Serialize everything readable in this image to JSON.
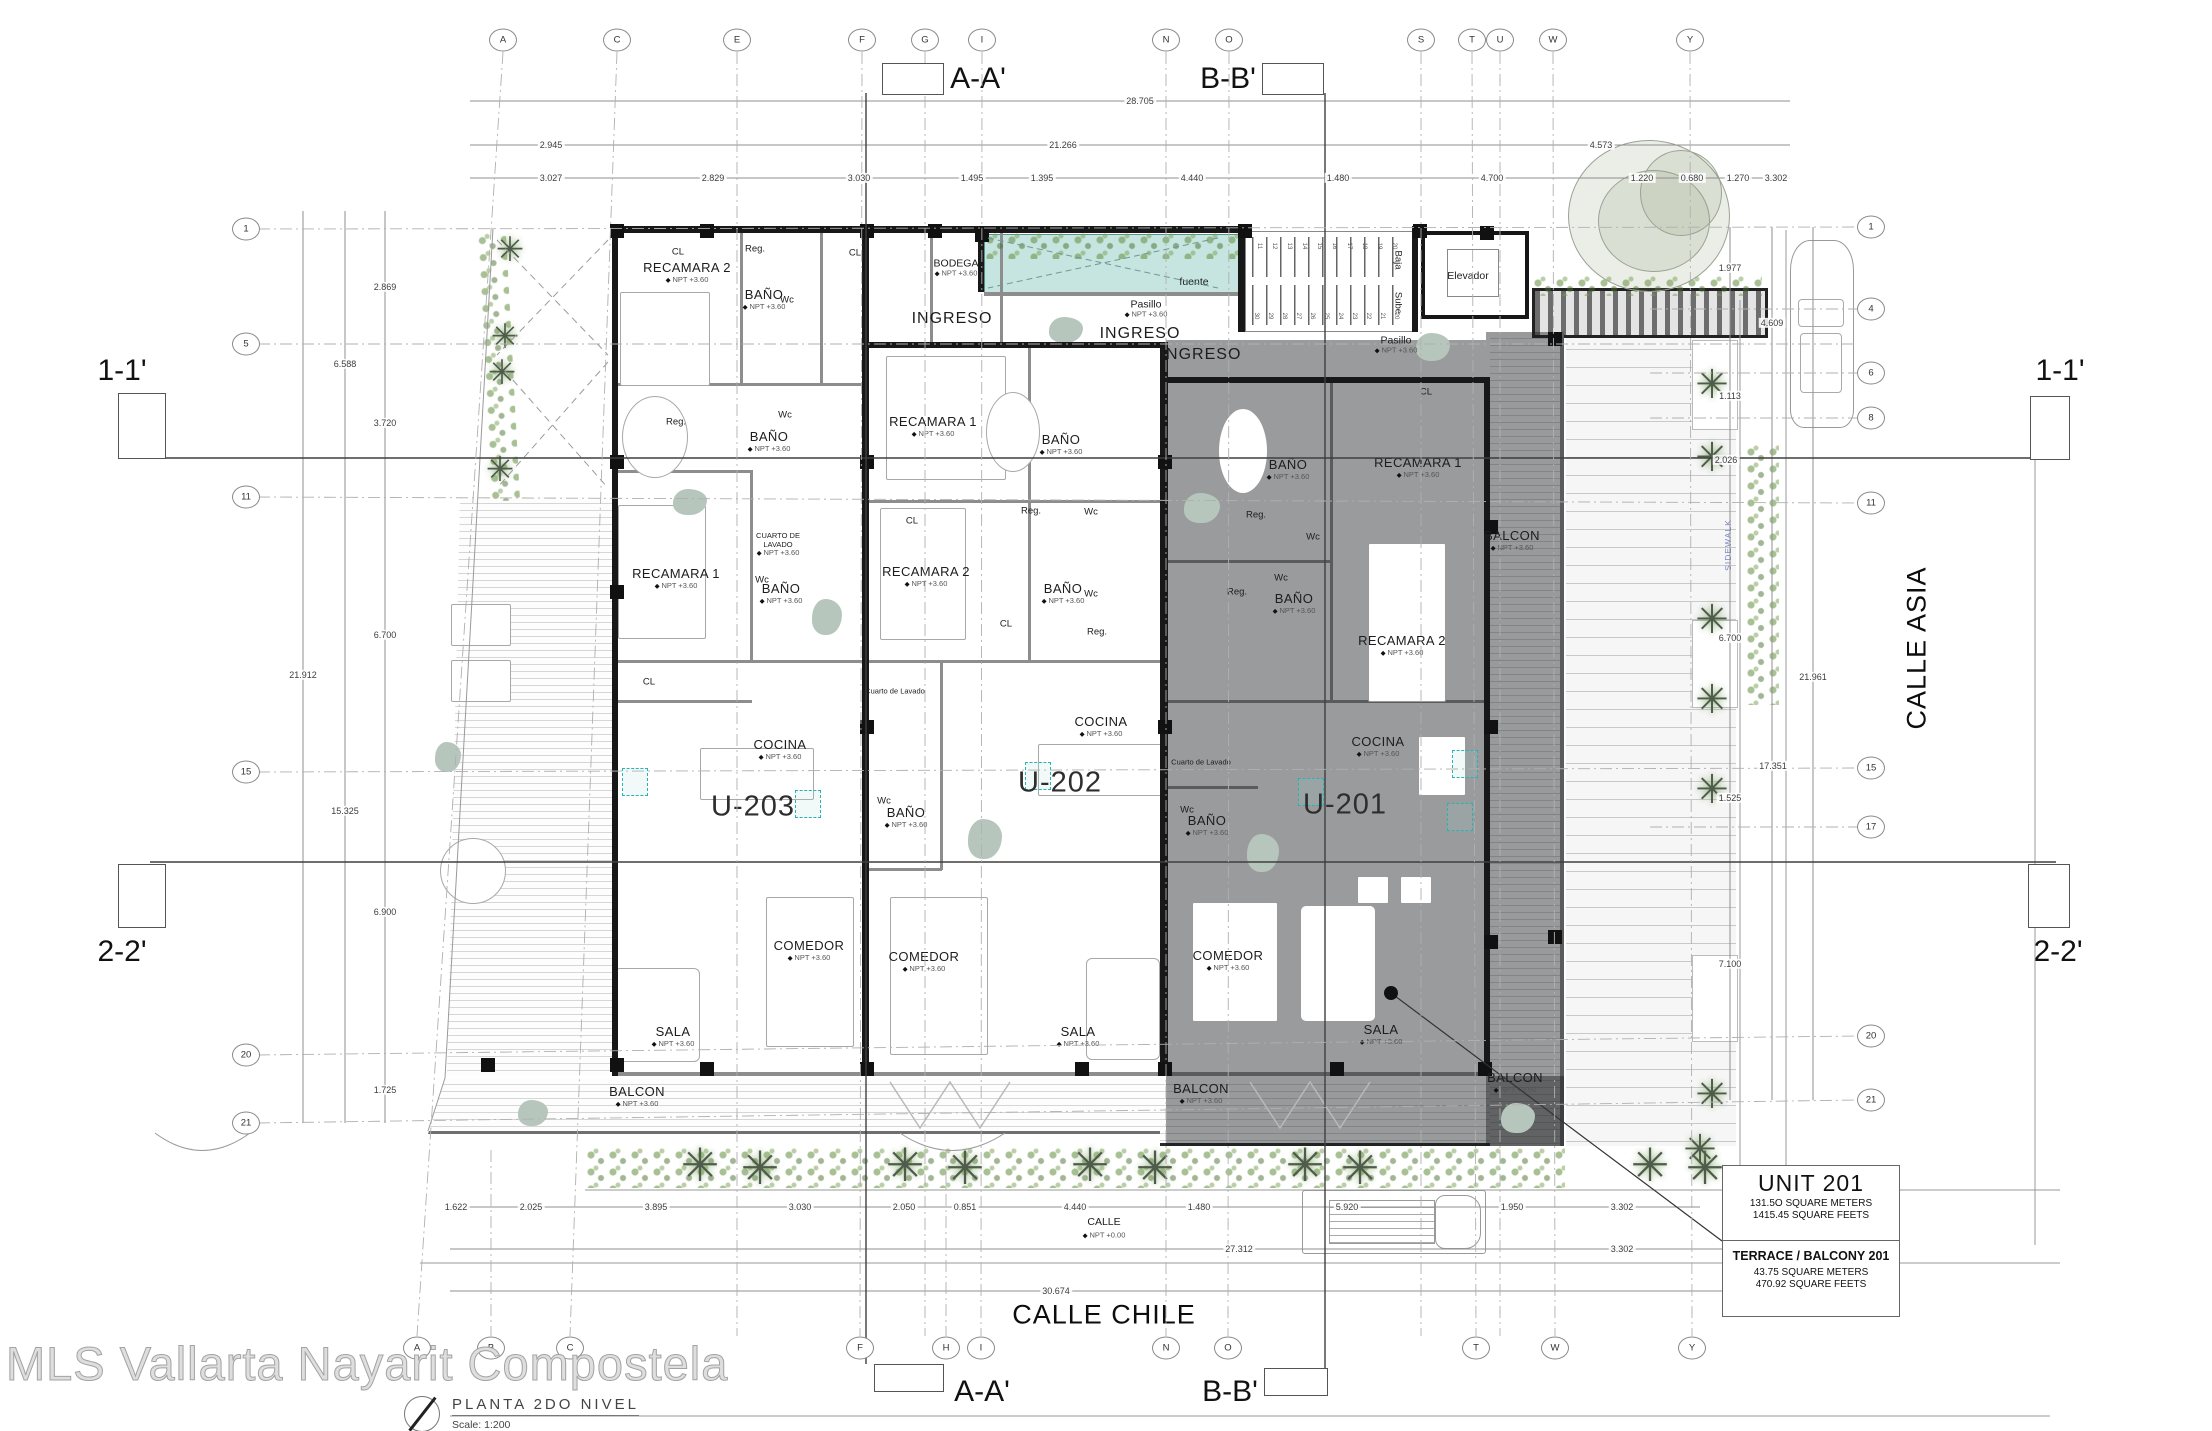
{
  "meta": {
    "watermark": "MLS Vallarta Nayarit Compostela",
    "sheet_title": "PLANTA  2DO  NIVEL",
    "scale_label": "Scale:  1:200"
  },
  "streets": {
    "bottom_street": "CALLE CHILE",
    "right_street": "CALLE ASIA",
    "street_small": "CALLE",
    "street_small_npt": "NPT +0.00",
    "sidewalk": "SIDEWALK"
  },
  "unit_box": {
    "title": "UNIT 201",
    "line1": "131.5O  SQUARE METERS",
    "line2": "1415.45  SQUARE FEETS",
    "title2": "TERRACE / BALCONY 201",
    "line3": "43.75  SQUARE METERS",
    "line4": "470.92  SQUARE FEETS"
  },
  "sections": {
    "aa": "A-A'",
    "bb": "B-B'",
    "s11": "1-1'",
    "s22": "2-2'"
  },
  "grid": {
    "top": [
      {
        "l": "A",
        "x": 503
      },
      {
        "l": "C",
        "x": 617
      },
      {
        "l": "E",
        "x": 737
      },
      {
        "l": "F",
        "x": 862
      },
      {
        "l": "G",
        "x": 925
      },
      {
        "l": "I",
        "x": 982
      },
      {
        "l": "N",
        "x": 1166
      },
      {
        "l": "O",
        "x": 1229
      },
      {
        "l": "S",
        "x": 1421
      },
      {
        "l": "T",
        "x": 1472
      },
      {
        "l": "U",
        "x": 1500
      },
      {
        "l": "W",
        "x": 1553
      },
      {
        "l": "Y",
        "x": 1690
      }
    ],
    "bottom": [
      {
        "l": "A",
        "x": 417
      },
      {
        "l": "B",
        "x": 491
      },
      {
        "l": "C",
        "x": 570
      },
      {
        "l": "F",
        "x": 860
      },
      {
        "l": "H",
        "x": 946
      },
      {
        "l": "I",
        "x": 981
      },
      {
        "l": "N",
        "x": 1166
      },
      {
        "l": "O",
        "x": 1228
      },
      {
        "l": "T",
        "x": 1476
      },
      {
        "l": "W",
        "x": 1555
      },
      {
        "l": "Y",
        "x": 1692
      }
    ],
    "left": [
      {
        "l": "1",
        "y": 229
      },
      {
        "l": "5",
        "y": 344
      },
      {
        "l": "11",
        "y": 497
      },
      {
        "l": "15",
        "y": 772
      },
      {
        "l": "20",
        "y": 1055
      },
      {
        "l": "21",
        "y": 1123
      }
    ],
    "right": [
      {
        "l": "1",
        "y": 227
      },
      {
        "l": "4",
        "y": 309
      },
      {
        "l": "6",
        "y": 373
      },
      {
        "l": "8",
        "y": 418
      },
      {
        "l": "11",
        "y": 503
      },
      {
        "l": "15",
        "y": 768
      },
      {
        "l": "17",
        "y": 827
      },
      {
        "l": "20",
        "y": 1036
      },
      {
        "l": "21",
        "y": 1100
      }
    ]
  },
  "dims": {
    "top": [
      {
        "t": "28.705",
        "x": 1140,
        "y": 101
      },
      {
        "t": "2.945",
        "x": 551,
        "y": 145
      },
      {
        "t": "21.266",
        "x": 1063,
        "y": 145
      },
      {
        "t": "4.573",
        "x": 1601,
        "y": 145
      },
      {
        "t": "3.027",
        "x": 551,
        "y": 178
      },
      {
        "t": "2.829",
        "x": 713,
        "y": 178
      },
      {
        "t": "3.030",
        "x": 859,
        "y": 178
      },
      {
        "t": "1.495",
        "x": 972,
        "y": 178
      },
      {
        "t": "1.395",
        "x": 1042,
        "y": 178
      },
      {
        "t": "4.440",
        "x": 1192,
        "y": 178
      },
      {
        "t": "1.480",
        "x": 1338,
        "y": 178
      },
      {
        "t": "4.700",
        "x": 1492,
        "y": 178
      },
      {
        "t": "1.220",
        "x": 1642,
        "y": 178
      },
      {
        "t": "0.680",
        "x": 1692,
        "y": 178
      },
      {
        "t": "1.270",
        "x": 1738,
        "y": 178
      },
      {
        "t": "3.302",
        "x": 1776,
        "y": 178
      }
    ],
    "left": [
      {
        "t": "2.869",
        "x": 385,
        "y": 287
      },
      {
        "t": "6.588",
        "x": 345,
        "y": 364
      },
      {
        "t": "3.720",
        "x": 385,
        "y": 423
      },
      {
        "t": "6.700",
        "x": 385,
        "y": 635
      },
      {
        "t": "21.912",
        "x": 303,
        "y": 675
      },
      {
        "t": "15.325",
        "x": 345,
        "y": 811
      },
      {
        "t": "6.900",
        "x": 385,
        "y": 912
      },
      {
        "t": "1.725",
        "x": 385,
        "y": 1090
      }
    ],
    "right": [
      {
        "t": "1.977",
        "x": 1730,
        "y": 268
      },
      {
        "t": "4.609",
        "x": 1772,
        "y": 323
      },
      {
        "t": "1.113",
        "x": 1730,
        "y": 396
      },
      {
        "t": "2.026",
        "x": 1726,
        "y": 460
      },
      {
        "t": "6.700",
        "x": 1730,
        "y": 638
      },
      {
        "t": "21.961",
        "x": 1813,
        "y": 677
      },
      {
        "t": "17.351",
        "x": 1773,
        "y": 766
      },
      {
        "t": "1.525",
        "x": 1730,
        "y": 798
      },
      {
        "t": "7.100",
        "x": 1730,
        "y": 964
      }
    ],
    "bottom": [
      {
        "t": "1.622",
        "x": 456,
        "y": 1207
      },
      {
        "t": "2.025",
        "x": 531,
        "y": 1207
      },
      {
        "t": "3.895",
        "x": 656,
        "y": 1207
      },
      {
        "t": "3.030",
        "x": 800,
        "y": 1207
      },
      {
        "t": "2.050",
        "x": 904,
        "y": 1207
      },
      {
        "t": "0.851",
        "x": 965,
        "y": 1207
      },
      {
        "t": "4.440",
        "x": 1075,
        "y": 1207
      },
      {
        "t": "1.480",
        "x": 1199,
        "y": 1207
      },
      {
        "t": "5.920",
        "x": 1347,
        "y": 1207
      },
      {
        "t": "1.950",
        "x": 1512,
        "y": 1207
      },
      {
        "t": "3.302",
        "x": 1622,
        "y": 1207
      },
      {
        "t": "27.312",
        "x": 1239,
        "y": 1249
      },
      {
        "t": "3.302",
        "x": 1622,
        "y": 1249
      },
      {
        "t": "30.674",
        "x": 1056,
        "y": 1291
      }
    ]
  },
  "labels": [
    {
      "t": "RECAMARA 2",
      "x": 687,
      "y": 273,
      "c": "room",
      "sub": "NPT +3.60"
    },
    {
      "t": "BAÑO",
      "x": 764,
      "y": 300,
      "c": "room",
      "sub": "NPT +3.60"
    },
    {
      "t": "RECAMARA 1",
      "x": 676,
      "y": 579,
      "c": "room",
      "sub": "NPT +3.60"
    },
    {
      "t": "BAÑO",
      "x": 769,
      "y": 442,
      "c": "room",
      "sub": "NPT +3.60"
    },
    {
      "t": "BAÑO",
      "x": 781,
      "y": 594,
      "c": "room",
      "sub": "NPT +3.60"
    },
    {
      "t": "CUARTO DE\nLAVADO",
      "x": 778,
      "y": 545,
      "c": "tiny",
      "sub": "NPT +3.60"
    },
    {
      "t": "COCINA",
      "x": 780,
      "y": 750,
      "c": "room",
      "sub": "NPT +3.60"
    },
    {
      "t": "U-203",
      "x": 753,
      "y": 807,
      "c": "unit"
    },
    {
      "t": "COMEDOR",
      "x": 809,
      "y": 951,
      "c": "room",
      "sub": "NPT +3.60"
    },
    {
      "t": "SALA",
      "x": 673,
      "y": 1037,
      "c": "room",
      "sub": "NPT +3.60"
    },
    {
      "t": "BALCON",
      "x": 637,
      "y": 1097,
      "c": "room",
      "sub": "NPT +3.60"
    },
    {
      "t": "BODEGA",
      "x": 956,
      "y": 268,
      "c": "med",
      "sub": "NPT +3.60"
    },
    {
      "t": "INGRESO",
      "x": 952,
      "y": 319,
      "c": "ingreso"
    },
    {
      "t": "INGRESO",
      "x": 1140,
      "y": 334,
      "c": "ingreso"
    },
    {
      "t": "INGRESO",
      "x": 1201,
      "y": 355,
      "c": "ingreso"
    },
    {
      "t": "RECAMARA 1",
      "x": 933,
      "y": 427,
      "c": "room",
      "sub": "NPT +3.60"
    },
    {
      "t": "RECAMARA 2",
      "x": 926,
      "y": 577,
      "c": "room",
      "sub": "NPT +3.60"
    },
    {
      "t": "BAÑO",
      "x": 1061,
      "y": 445,
      "c": "room",
      "sub": "NPT +3.60"
    },
    {
      "t": "BAÑO",
      "x": 1063,
      "y": 594,
      "c": "room",
      "sub": "NPT +3.60"
    },
    {
      "t": "BAÑO",
      "x": 906,
      "y": 818,
      "c": "room",
      "sub": "NPT +3.60"
    },
    {
      "t": "Cuarto de Lavado",
      "x": 895,
      "y": 692,
      "c": "tiny"
    },
    {
      "t": "COCINA",
      "x": 1101,
      "y": 727,
      "c": "room",
      "sub": "NPT +3.60"
    },
    {
      "t": "U-202",
      "x": 1060,
      "y": 783,
      "c": "unit"
    },
    {
      "t": "COMEDOR",
      "x": 924,
      "y": 962,
      "c": "room",
      "sub": "NPT +3.60"
    },
    {
      "t": "SALA",
      "x": 1078,
      "y": 1037,
      "c": "room",
      "sub": "NPT +3.60"
    },
    {
      "t": "BAÑO",
      "x": 1288,
      "y": 470,
      "c": "room",
      "sub": "NPT +3.60"
    },
    {
      "t": "RECAMARA 1",
      "x": 1418,
      "y": 468,
      "c": "room",
      "sub": "NPT +3.60"
    },
    {
      "t": "BAÑO",
      "x": 1294,
      "y": 604,
      "c": "room",
      "sub": "NPT +3.60"
    },
    {
      "t": "RECAMARA 2",
      "x": 1402,
      "y": 646,
      "c": "room",
      "sub": "NPT +3.60"
    },
    {
      "t": "BALCON",
      "x": 1512,
      "y": 541,
      "c": "room",
      "sub": "NPT +3.60"
    },
    {
      "t": "Cuarto de Lavado",
      "x": 1201,
      "y": 763,
      "c": "tiny"
    },
    {
      "t": "BAÑO",
      "x": 1207,
      "y": 826,
      "c": "room",
      "sub": "NPT +3.60"
    },
    {
      "t": "COCINA",
      "x": 1378,
      "y": 747,
      "c": "room",
      "sub": "NPT +3.60"
    },
    {
      "t": "U-201",
      "x": 1345,
      "y": 805,
      "c": "unit"
    },
    {
      "t": "COMEDOR",
      "x": 1228,
      "y": 961,
      "c": "room",
      "sub": "NPT +3.60"
    },
    {
      "t": "SALA",
      "x": 1381,
      "y": 1035,
      "c": "room",
      "sub": "NPT +3.60"
    },
    {
      "t": "BALCON",
      "x": 1201,
      "y": 1094,
      "c": "room",
      "sub": "NPT +3.60"
    },
    {
      "t": "BALCON",
      "x": 1515,
      "y": 1083,
      "c": "room",
      "sub": "NPT +3.60"
    },
    {
      "t": "Pasillo",
      "x": 1146,
      "y": 309,
      "c": "med",
      "sub": "NPT +3.60"
    },
    {
      "t": "Pasillo",
      "x": 1396,
      "y": 345,
      "c": "med",
      "sub": "NPT +3.60"
    },
    {
      "t": "fuente",
      "x": 1194,
      "y": 282,
      "c": "med"
    },
    {
      "t": "Elevador",
      "x": 1468,
      "y": 276,
      "c": "med"
    },
    {
      "t": "Baja",
      "x": 1397,
      "y": 260,
      "c": "small",
      "rot": 90
    },
    {
      "t": "Sube",
      "x": 1397,
      "y": 303,
      "c": "small",
      "rot": 90
    },
    {
      "t": "Reg.",
      "x": 755,
      "y": 250,
      "c": "small"
    },
    {
      "t": "Wc",
      "x": 787,
      "y": 301,
      "c": "small"
    },
    {
      "t": "CL",
      "x": 678,
      "y": 253,
      "c": "small"
    },
    {
      "t": "CL",
      "x": 855,
      "y": 254,
      "c": "small"
    },
    {
      "t": "Reg.",
      "x": 676,
      "y": 423,
      "c": "small"
    },
    {
      "t": "Wc",
      "x": 785,
      "y": 416,
      "c": "small"
    },
    {
      "t": "Wc",
      "x": 762,
      "y": 581,
      "c": "small"
    },
    {
      "t": "CL",
      "x": 649,
      "y": 683,
      "c": "small"
    },
    {
      "t": "CL",
      "x": 912,
      "y": 522,
      "c": "small"
    },
    {
      "t": "Reg.",
      "x": 1031,
      "y": 512,
      "c": "small"
    },
    {
      "t": "Wc",
      "x": 1091,
      "y": 513,
      "c": "small"
    },
    {
      "t": "Wc",
      "x": 1091,
      "y": 595,
      "c": "small"
    },
    {
      "t": "Reg.",
      "x": 1097,
      "y": 633,
      "c": "small"
    },
    {
      "t": "CL",
      "x": 1006,
      "y": 625,
      "c": "small"
    },
    {
      "t": "Wc",
      "x": 884,
      "y": 802,
      "c": "small"
    },
    {
      "t": "CL",
      "x": 1426,
      "y": 393,
      "c": "small"
    },
    {
      "t": "Reg.",
      "x": 1256,
      "y": 516,
      "c": "small"
    },
    {
      "t": "Wc",
      "x": 1313,
      "y": 538,
      "c": "small"
    },
    {
      "t": "Wc",
      "x": 1281,
      "y": 579,
      "c": "small"
    },
    {
      "t": "Reg.",
      "x": 1237,
      "y": 593,
      "c": "small"
    },
    {
      "t": "Wc",
      "x": 1187,
      "y": 811,
      "c": "small"
    }
  ],
  "stairs": {
    "upper_numbers": [
      "11",
      "12",
      "13",
      "14",
      "15",
      "16",
      "17",
      "18",
      "19",
      "20"
    ],
    "lower_numbers": [
      "30",
      "29",
      "28",
      "27",
      "26",
      "25",
      "24",
      "23",
      "22",
      "21",
      "20"
    ]
  },
  "colors": {
    "fountain": "#c7e5e0",
    "overlay": "rgba(25,28,30,0.44)",
    "teal_fixture": "#2ab3b3",
    "plant_green": "#608e3c",
    "wall": "#181818",
    "sidewalk_blue": "#7b86c8"
  }
}
